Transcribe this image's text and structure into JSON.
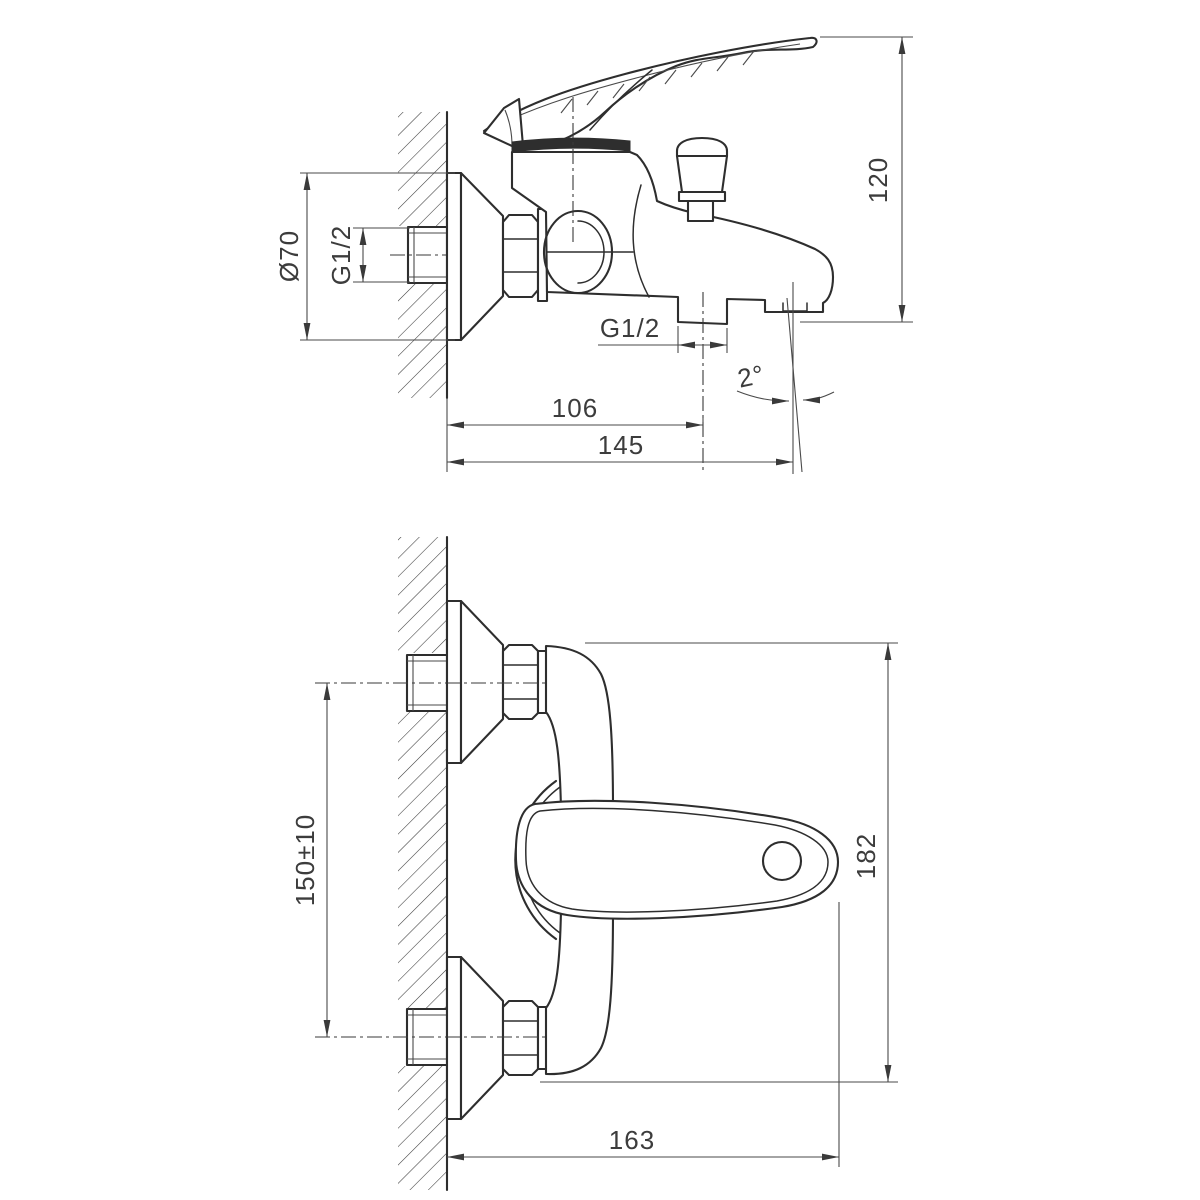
{
  "drawing": {
    "type": "technical-drawing",
    "subject": "wall-mounted bath mixer faucet, two orthographic views",
    "background_color": "#ffffff",
    "line_color": "#2e2e2e",
    "views": {
      "side_view": {
        "name": "side view (section at wall)",
        "dimensions": {
          "flange_diameter": "Ø70",
          "wall_thread": "G1/2",
          "height": "120",
          "shower_outlet_thread": "G1/2",
          "spout_center_distance": "106",
          "spout_reach": "145",
          "spout_angle": "2°"
        }
      },
      "front_view": {
        "name": "front view",
        "dimensions": {
          "connection_spacing": "150±10",
          "body_height": "182",
          "overall_reach": "163"
        }
      }
    }
  }
}
